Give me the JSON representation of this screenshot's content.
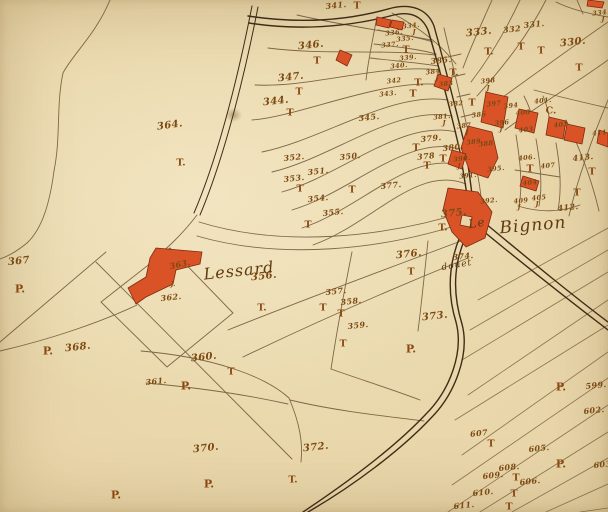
{
  "theme": {
    "paper": "#e8d5a8",
    "line": "#6b5232",
    "road": "#3f2c18",
    "building_fill": "#d95327",
    "building_stroke": "#7e2a10",
    "ink": "#7c4a12",
    "mark_ink": "#8a4712",
    "place_ink": "#5f3a10"
  },
  "map": {
    "place_labels": [
      {
        "text": "Lessard",
        "x": 239,
        "y": 271,
        "size": 16,
        "rot": -6
      },
      {
        "text": "Le",
        "x": 477,
        "y": 223,
        "size": 12,
        "rot": -10
      },
      {
        "text": "Bignon",
        "x": 533,
        "y": 226,
        "size": 17,
        "rot": -5
      },
      {
        "text": "douet",
        "x": 457,
        "y": 266,
        "size": 9,
        "rot": -10
      }
    ],
    "parcel_numbers": [
      {
        "text": "364.",
        "x": 170,
        "y": 126,
        "sz": "b",
        "rot": -8
      },
      {
        "text": "367",
        "x": 19,
        "y": 262,
        "sz": "b"
      },
      {
        "text": "368.",
        "x": 78,
        "y": 348,
        "sz": "b"
      },
      {
        "text": "341.",
        "x": 336,
        "y": 5,
        "sz": "m"
      },
      {
        "text": "346.",
        "x": 311,
        "y": 46,
        "sz": "b"
      },
      {
        "text": "347.",
        "x": 291,
        "y": 78,
        "sz": "b"
      },
      {
        "text": "344.",
        "x": 276,
        "y": 102,
        "sz": "b"
      },
      {
        "text": "345.",
        "x": 369,
        "y": 117,
        "sz": "m"
      },
      {
        "text": "333.",
        "x": 479,
        "y": 33,
        "sz": "b"
      },
      {
        "text": "332",
        "x": 512,
        "y": 29,
        "sz": "m"
      },
      {
        "text": "331.",
        "x": 534,
        "y": 24,
        "sz": "m"
      },
      {
        "text": "330.",
        "x": 573,
        "y": 43,
        "sz": "b"
      },
      {
        "text": "334.",
        "x": 601,
        "y": 13,
        "sz": "s"
      },
      {
        "text": "350.",
        "x": 350,
        "y": 156,
        "sz": "m"
      },
      {
        "text": "351.",
        "x": 318,
        "y": 171,
        "sz": "m"
      },
      {
        "text": "352.",
        "x": 294,
        "y": 157,
        "sz": "m"
      },
      {
        "text": "353.",
        "x": 294,
        "y": 178,
        "sz": "m"
      },
      {
        "text": "354.",
        "x": 318,
        "y": 198,
        "sz": "m"
      },
      {
        "text": "355.",
        "x": 333,
        "y": 212,
        "sz": "m"
      },
      {
        "text": "356.",
        "x": 264,
        "y": 277,
        "sz": "b"
      },
      {
        "text": "357.",
        "x": 336,
        "y": 291,
        "sz": "m"
      },
      {
        "text": "358.",
        "x": 351,
        "y": 301,
        "sz": "m"
      },
      {
        "text": "359.",
        "x": 358,
        "y": 325,
        "sz": "m"
      },
      {
        "text": "360.",
        "x": 204,
        "y": 358,
        "sz": "b"
      },
      {
        "text": "361.",
        "x": 156,
        "y": 381,
        "sz": "m"
      },
      {
        "text": "362.",
        "x": 171,
        "y": 297,
        "sz": "m"
      },
      {
        "text": "363.",
        "x": 180,
        "y": 264,
        "sz": "m",
        "rot": -12
      },
      {
        "text": "370.",
        "x": 206,
        "y": 449,
        "sz": "b"
      },
      {
        "text": "372.",
        "x": 316,
        "y": 448,
        "sz": "b"
      },
      {
        "text": "373.",
        "x": 435,
        "y": 317,
        "sz": "b"
      },
      {
        "text": "374.",
        "x": 463,
        "y": 256,
        "sz": "m"
      },
      {
        "text": "375.",
        "x": 454,
        "y": 214,
        "sz": "b"
      },
      {
        "text": "376.",
        "x": 409,
        "y": 255,
        "sz": "b"
      },
      {
        "text": "377.",
        "x": 391,
        "y": 185,
        "sz": "m"
      },
      {
        "text": "378",
        "x": 426,
        "y": 156,
        "sz": "m"
      },
      {
        "text": "379.",
        "x": 431,
        "y": 138,
        "sz": "m"
      },
      {
        "text": "380.",
        "x": 453,
        "y": 147,
        "sz": "m"
      },
      {
        "text": "381.",
        "x": 442,
        "y": 117,
        "sz": "s"
      },
      {
        "text": "382",
        "x": 456,
        "y": 104,
        "sz": "s"
      },
      {
        "text": "383",
        "x": 446,
        "y": 84,
        "sz": "s"
      },
      {
        "text": "384",
        "x": 433,
        "y": 72,
        "sz": "s"
      },
      {
        "text": "385.",
        "x": 441,
        "y": 60,
        "sz": "m"
      },
      {
        "text": "386",
        "x": 479,
        "y": 115,
        "sz": "s"
      },
      {
        "text": "387",
        "x": 464,
        "y": 126,
        "sz": "s"
      },
      {
        "text": "388",
        "x": 486,
        "y": 144,
        "sz": "s"
      },
      {
        "text": "389.",
        "x": 475,
        "y": 142,
        "sz": "s"
      },
      {
        "text": "390.",
        "x": 462,
        "y": 159,
        "sz": "s"
      },
      {
        "text": "391.",
        "x": 468,
        "y": 176,
        "sz": "s"
      },
      {
        "text": "392.",
        "x": 489,
        "y": 201,
        "sz": "s"
      },
      {
        "text": "394",
        "x": 511,
        "y": 106,
        "sz": "s"
      },
      {
        "text": "395.",
        "x": 496,
        "y": 169,
        "sz": "s"
      },
      {
        "text": "396",
        "x": 502,
        "y": 123,
        "sz": "s"
      },
      {
        "text": "397",
        "x": 494,
        "y": 104,
        "sz": "s"
      },
      {
        "text": "398",
        "x": 488,
        "y": 81,
        "sz": "s"
      },
      {
        "text": "400",
        "x": 523,
        "y": 113,
        "sz": "s"
      },
      {
        "text": "401.",
        "x": 543,
        "y": 101,
        "sz": "s"
      },
      {
        "text": "402",
        "x": 561,
        "y": 125,
        "sz": "s"
      },
      {
        "text": "403",
        "x": 526,
        "y": 130,
        "sz": "s"
      },
      {
        "text": "404",
        "x": 530,
        "y": 183,
        "sz": "s"
      },
      {
        "text": "405",
        "x": 539,
        "y": 198,
        "sz": "s"
      },
      {
        "text": "406.",
        "x": 527,
        "y": 158,
        "sz": "s"
      },
      {
        "text": "407",
        "x": 548,
        "y": 166,
        "sz": "s"
      },
      {
        "text": "409",
        "x": 521,
        "y": 201,
        "sz": "s"
      },
      {
        "text": "411.",
        "x": 601,
        "y": 133,
        "sz": "s"
      },
      {
        "text": "412.",
        "x": 568,
        "y": 207,
        "sz": "m"
      },
      {
        "text": "413.",
        "x": 583,
        "y": 157,
        "sz": "m"
      },
      {
        "text": "335.",
        "x": 405,
        "y": 39,
        "sz": "s"
      },
      {
        "text": "336.",
        "x": 394,
        "y": 33,
        "sz": "s"
      },
      {
        "text": "337.",
        "x": 390,
        "y": 45,
        "sz": "s"
      },
      {
        "text": "339.",
        "x": 408,
        "y": 58,
        "sz": "s"
      },
      {
        "text": "340.",
        "x": 399,
        "y": 66,
        "sz": "s"
      },
      {
        "text": "342",
        "x": 394,
        "y": 81,
        "sz": "s"
      },
      {
        "text": "343.",
        "x": 388,
        "y": 94,
        "sz": "s"
      },
      {
        "text": "334.",
        "x": 411,
        "y": 26,
        "sz": "s"
      },
      {
        "text": "599.",
        "x": 596,
        "y": 385,
        "sz": "m"
      },
      {
        "text": "602.",
        "x": 594,
        "y": 410,
        "sz": "m"
      },
      {
        "text": "603.",
        "x": 604,
        "y": 464,
        "sz": "m"
      },
      {
        "text": "605.",
        "x": 539,
        "y": 448,
        "sz": "m"
      },
      {
        "text": "606.",
        "x": 530,
        "y": 481,
        "sz": "m"
      },
      {
        "text": "607",
        "x": 479,
        "y": 433,
        "sz": "m"
      },
      {
        "text": "608.",
        "x": 509,
        "y": 467,
        "sz": "m"
      },
      {
        "text": "609.",
        "x": 493,
        "y": 475,
        "sz": "m"
      },
      {
        "text": "610.",
        "x": 483,
        "y": 492,
        "sz": "m"
      },
      {
        "text": "611.",
        "x": 464,
        "y": 505,
        "sz": "m"
      }
    ],
    "landuse_marks": [
      {
        "text": "T",
        "x": 357,
        "y": 6
      },
      {
        "text": "T",
        "x": 317,
        "y": 61
      },
      {
        "text": "T",
        "x": 299,
        "y": 92
      },
      {
        "text": "T",
        "x": 290,
        "y": 113
      },
      {
        "text": "T.",
        "x": 181,
        "y": 163
      },
      {
        "text": "T",
        "x": 406,
        "y": 50
      },
      {
        "text": "T.",
        "x": 454,
        "y": 73
      },
      {
        "text": "T.",
        "x": 419,
        "y": 83
      },
      {
        "text": "T",
        "x": 413,
        "y": 94
      },
      {
        "text": "T",
        "x": 472,
        "y": 103
      },
      {
        "text": "T.",
        "x": 489,
        "y": 52
      },
      {
        "text": "T",
        "x": 521,
        "y": 47
      },
      {
        "text": "T",
        "x": 541,
        "y": 51
      },
      {
        "text": "T",
        "x": 579,
        "y": 68
      },
      {
        "text": "T",
        "x": 416,
        "y": 148
      },
      {
        "text": "T",
        "x": 427,
        "y": 166
      },
      {
        "text": "T",
        "x": 443,
        "y": 159
      },
      {
        "text": "T",
        "x": 530,
        "y": 169
      },
      {
        "text": "T",
        "x": 592,
        "y": 172
      },
      {
        "text": "T",
        "x": 577,
        "y": 193
      },
      {
        "text": "T.",
        "x": 443,
        "y": 228
      },
      {
        "text": "T",
        "x": 411,
        "y": 272
      },
      {
        "text": "T",
        "x": 300,
        "y": 189
      },
      {
        "text": "T",
        "x": 352,
        "y": 190
      },
      {
        "text": "T",
        "x": 308,
        "y": 225
      },
      {
        "text": "T",
        "x": 323,
        "y": 308
      },
      {
        "text": "T",
        "x": 341,
        "y": 314
      },
      {
        "text": "T",
        "x": 343,
        "y": 344
      },
      {
        "text": "T.",
        "x": 262,
        "y": 308
      },
      {
        "text": "T",
        "x": 231,
        "y": 372
      },
      {
        "text": "T.",
        "x": 293,
        "y": 480
      },
      {
        "text": "T",
        "x": 491,
        "y": 444
      },
      {
        "text": "T",
        "x": 516,
        "y": 478
      },
      {
        "text": "T",
        "x": 514,
        "y": 494
      },
      {
        "text": "T",
        "x": 509,
        "y": 507
      },
      {
        "text": "P.",
        "x": 20,
        "y": 289,
        "sz": "b"
      },
      {
        "text": "P.",
        "x": 48,
        "y": 351,
        "sz": "b"
      },
      {
        "text": "P.",
        "x": 186,
        "y": 386,
        "sz": "b"
      },
      {
        "text": "P.",
        "x": 209,
        "y": 484,
        "sz": "b"
      },
      {
        "text": "P.",
        "x": 116,
        "y": 495,
        "sz": "b"
      },
      {
        "text": "P.",
        "x": 411,
        "y": 349,
        "sz": "b"
      },
      {
        "text": "P.",
        "x": 561,
        "y": 387,
        "sz": "b"
      },
      {
        "text": "P.",
        "x": 561,
        "y": 464,
        "sz": "b"
      },
      {
        "text": "J",
        "x": 414,
        "y": 32,
        "sz": "s"
      },
      {
        "text": "J",
        "x": 437,
        "y": 78,
        "sz": "s"
      },
      {
        "text": "J",
        "x": 488,
        "y": 88,
        "sz": "s"
      },
      {
        "text": "J",
        "x": 501,
        "y": 129,
        "sz": "s"
      },
      {
        "text": "J",
        "x": 444,
        "y": 123,
        "sz": "s"
      },
      {
        "text": "J",
        "x": 467,
        "y": 132,
        "sz": "s"
      },
      {
        "text": "J",
        "x": 459,
        "y": 166,
        "sz": "s"
      },
      {
        "text": "J",
        "x": 519,
        "y": 207,
        "sz": "s"
      },
      {
        "text": "J",
        "x": 537,
        "y": 204,
        "sz": "s"
      },
      {
        "text": "J",
        "x": 603,
        "y": 19,
        "sz": "s"
      },
      {
        "text": "J.",
        "x": 173,
        "y": 284,
        "sz": "s"
      },
      {
        "text": "C.",
        "x": 551,
        "y": 111
      }
    ]
  }
}
